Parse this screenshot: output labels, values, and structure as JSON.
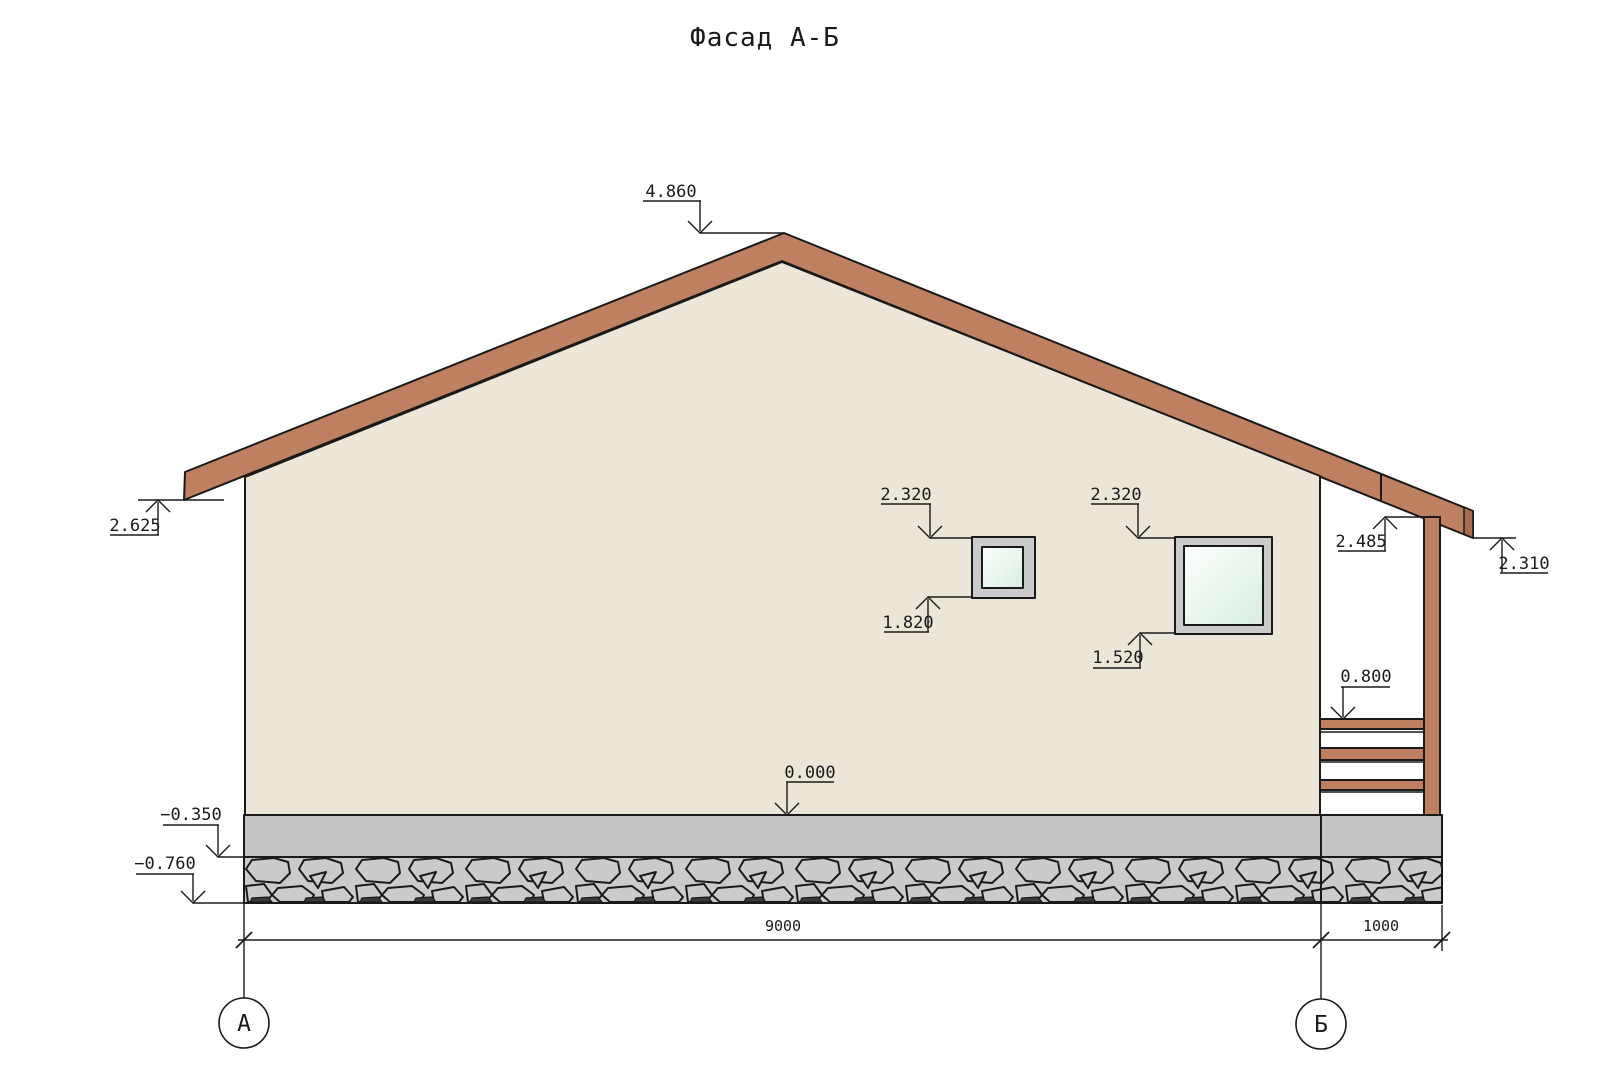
{
  "title": "Фасад А-Б",
  "marks": {
    "ridge": "4.860",
    "eave_left": "2.625",
    "window_small_top": "2.320",
    "window_small_bottom": "1.820",
    "window_large_top": "2.320",
    "window_large_bottom": "1.520",
    "porch_beam": "2.485",
    "eave_right": "2.310",
    "porch_railing": "0.800",
    "ground_level": "0.000",
    "plinth_top": "−0.350",
    "footing_bottom": "−0.760"
  },
  "dimensions": {
    "wall_span": "9000",
    "porch_span": "1000"
  },
  "axes": {
    "left": "А",
    "right": "Б"
  },
  "colors": {
    "roof": "#bf8061",
    "roof_end_dark": "#a96b51",
    "wall": "#ebe6d7",
    "plinth": "#c4c4c6",
    "stone": "#cbcbcb",
    "stone_dark": "#3a3a3a",
    "window_frame": "#cbcbcb",
    "glass_light": "#fdfffd",
    "glass_dark": "#d9eee1",
    "line": "#1a1a1a",
    "paper": "#ffffff"
  }
}
